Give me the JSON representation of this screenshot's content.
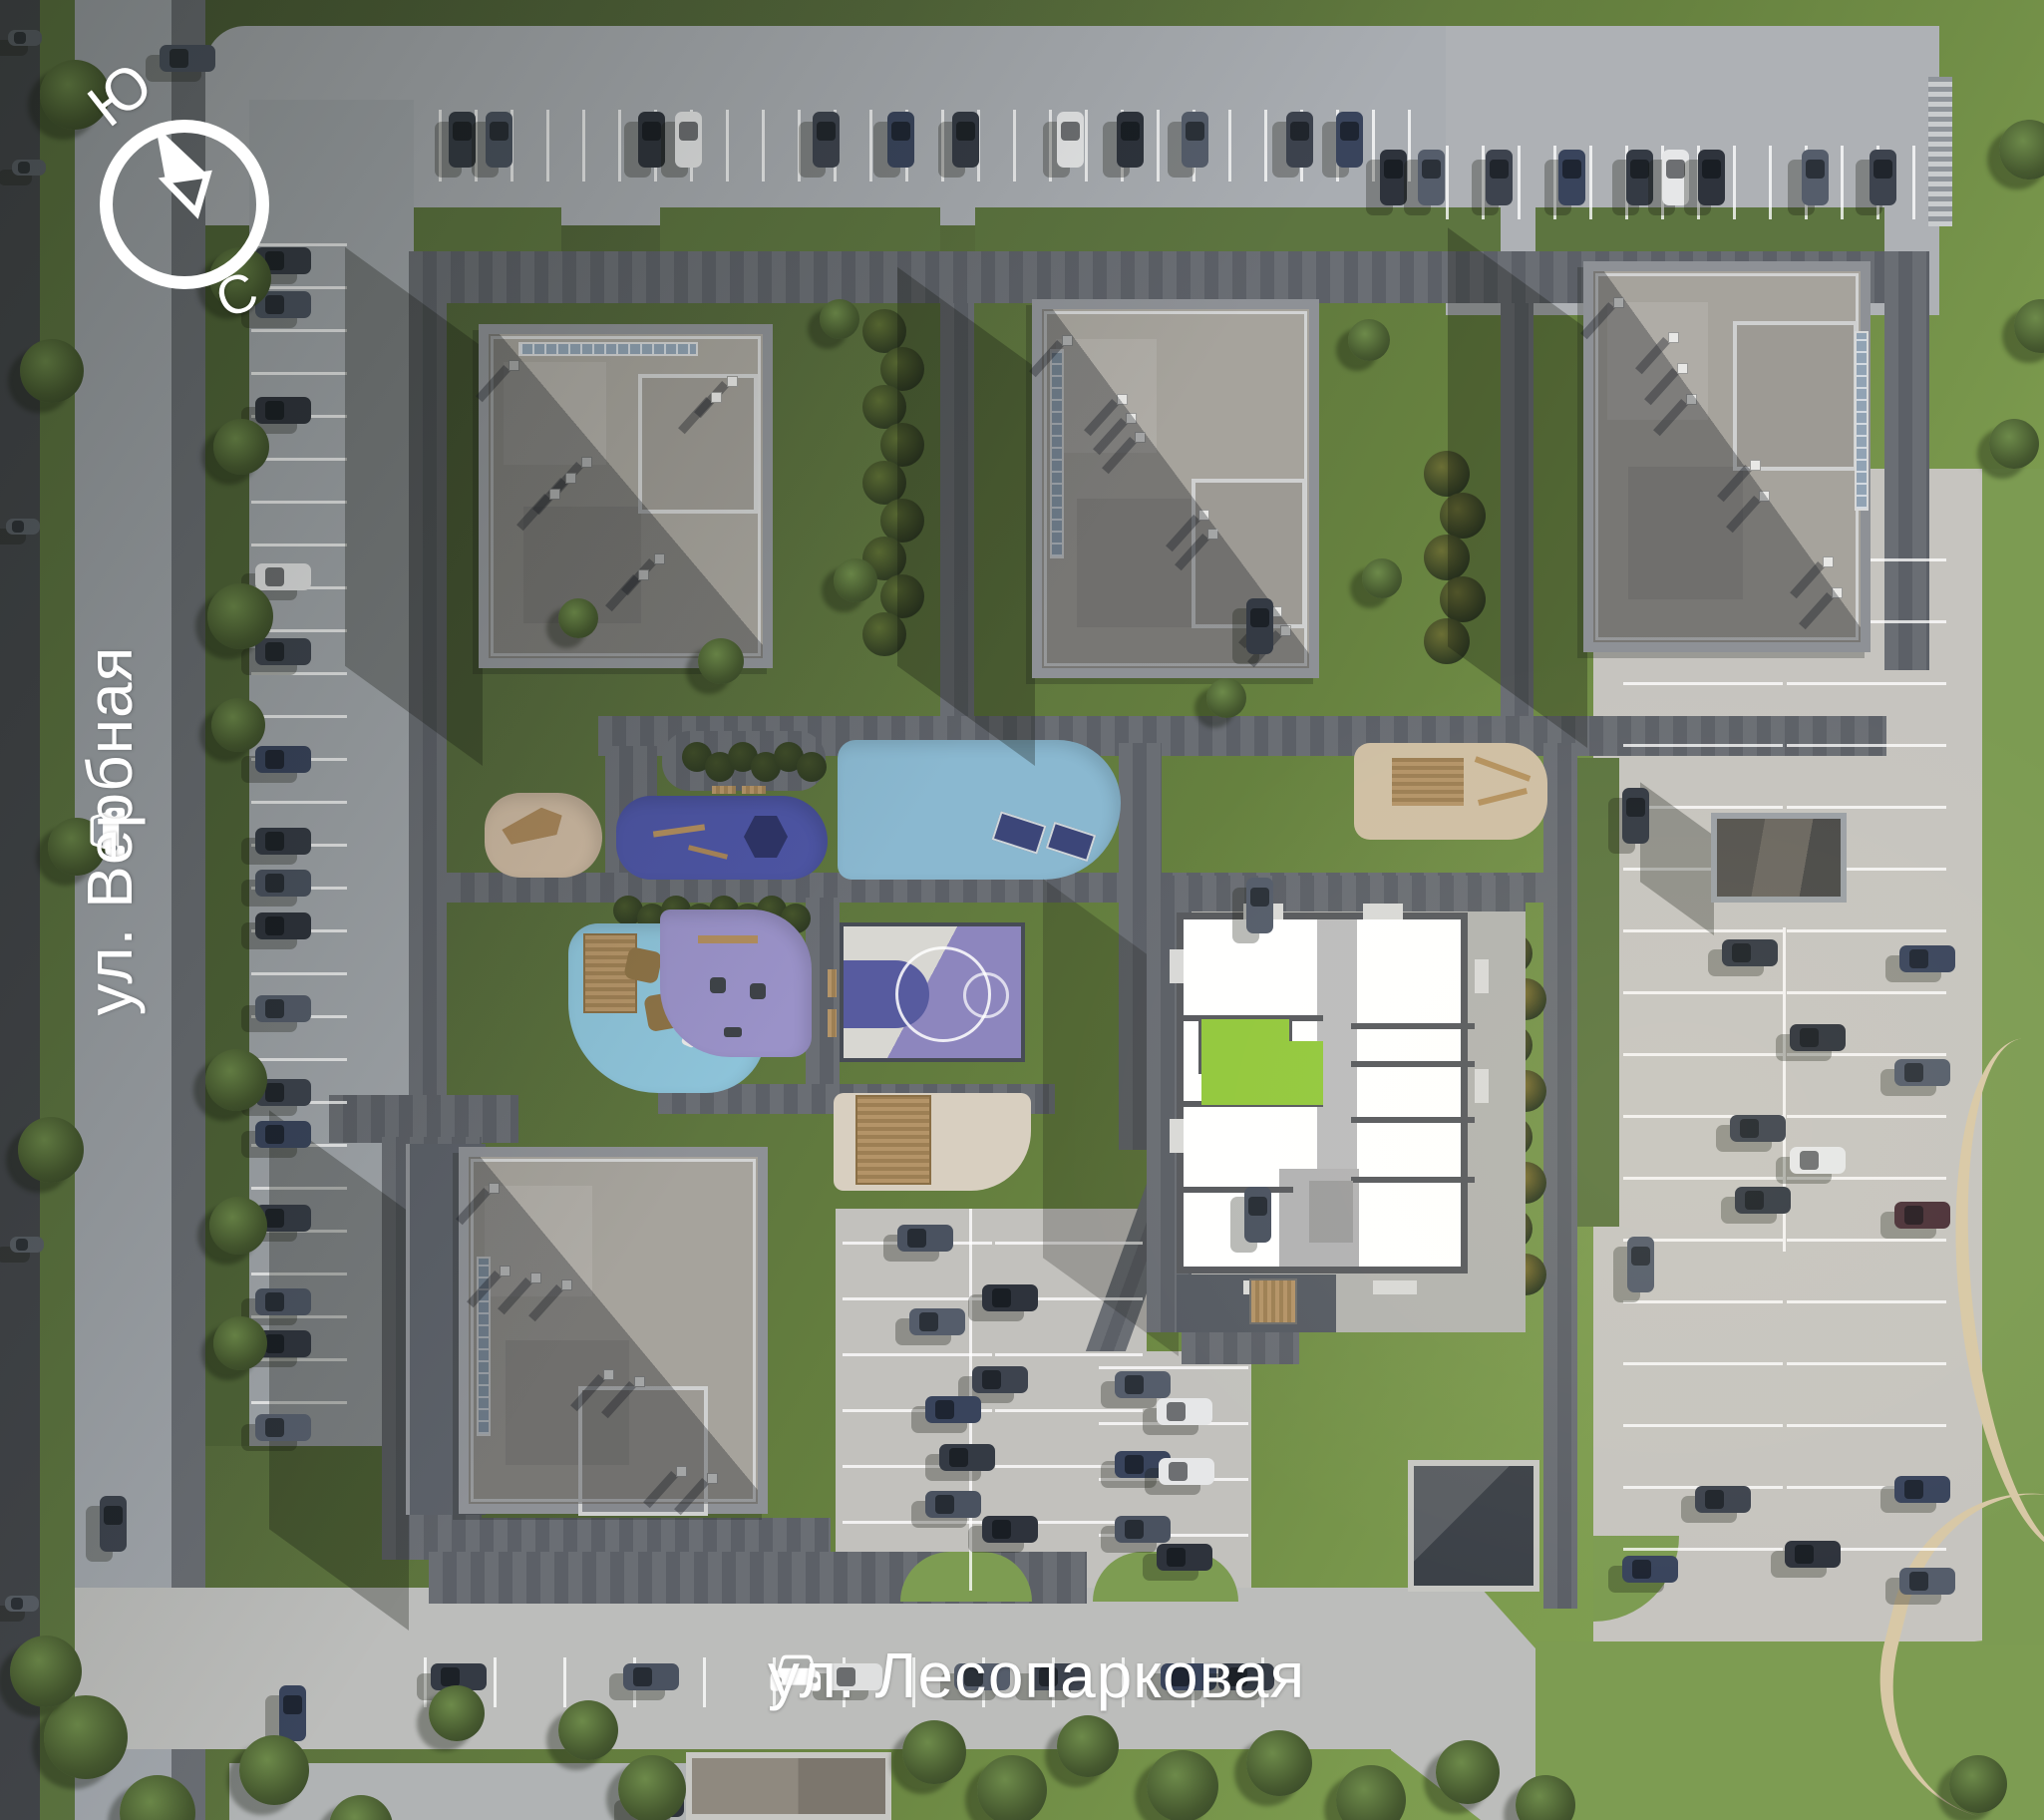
{
  "compass": {
    "south": "Ю",
    "north": "С",
    "icon": "compass-needle-icon"
  },
  "streets": {
    "verbnaya": {
      "label": "ул. Вербная",
      "icon": "car-icon"
    },
    "lesoparkovaya": {
      "label": "ул. Лесопарковая",
      "icon": "car-icon"
    }
  },
  "colors": {
    "apartment-highlight": "#93c83d",
    "playground-navy": "#4d55a4",
    "fitness-blue": "#8ab8d0",
    "kids-blue": "#8ec4da",
    "kids-purple": "#9a92c8",
    "court-purple": "#8d86be",
    "court-key-blue": "#575b9f",
    "grass-sunlit": "#7d9c52",
    "road-light": "#a9adb2",
    "paver-dark": "#62666d",
    "sand-beige": "#cdb9a2"
  }
}
